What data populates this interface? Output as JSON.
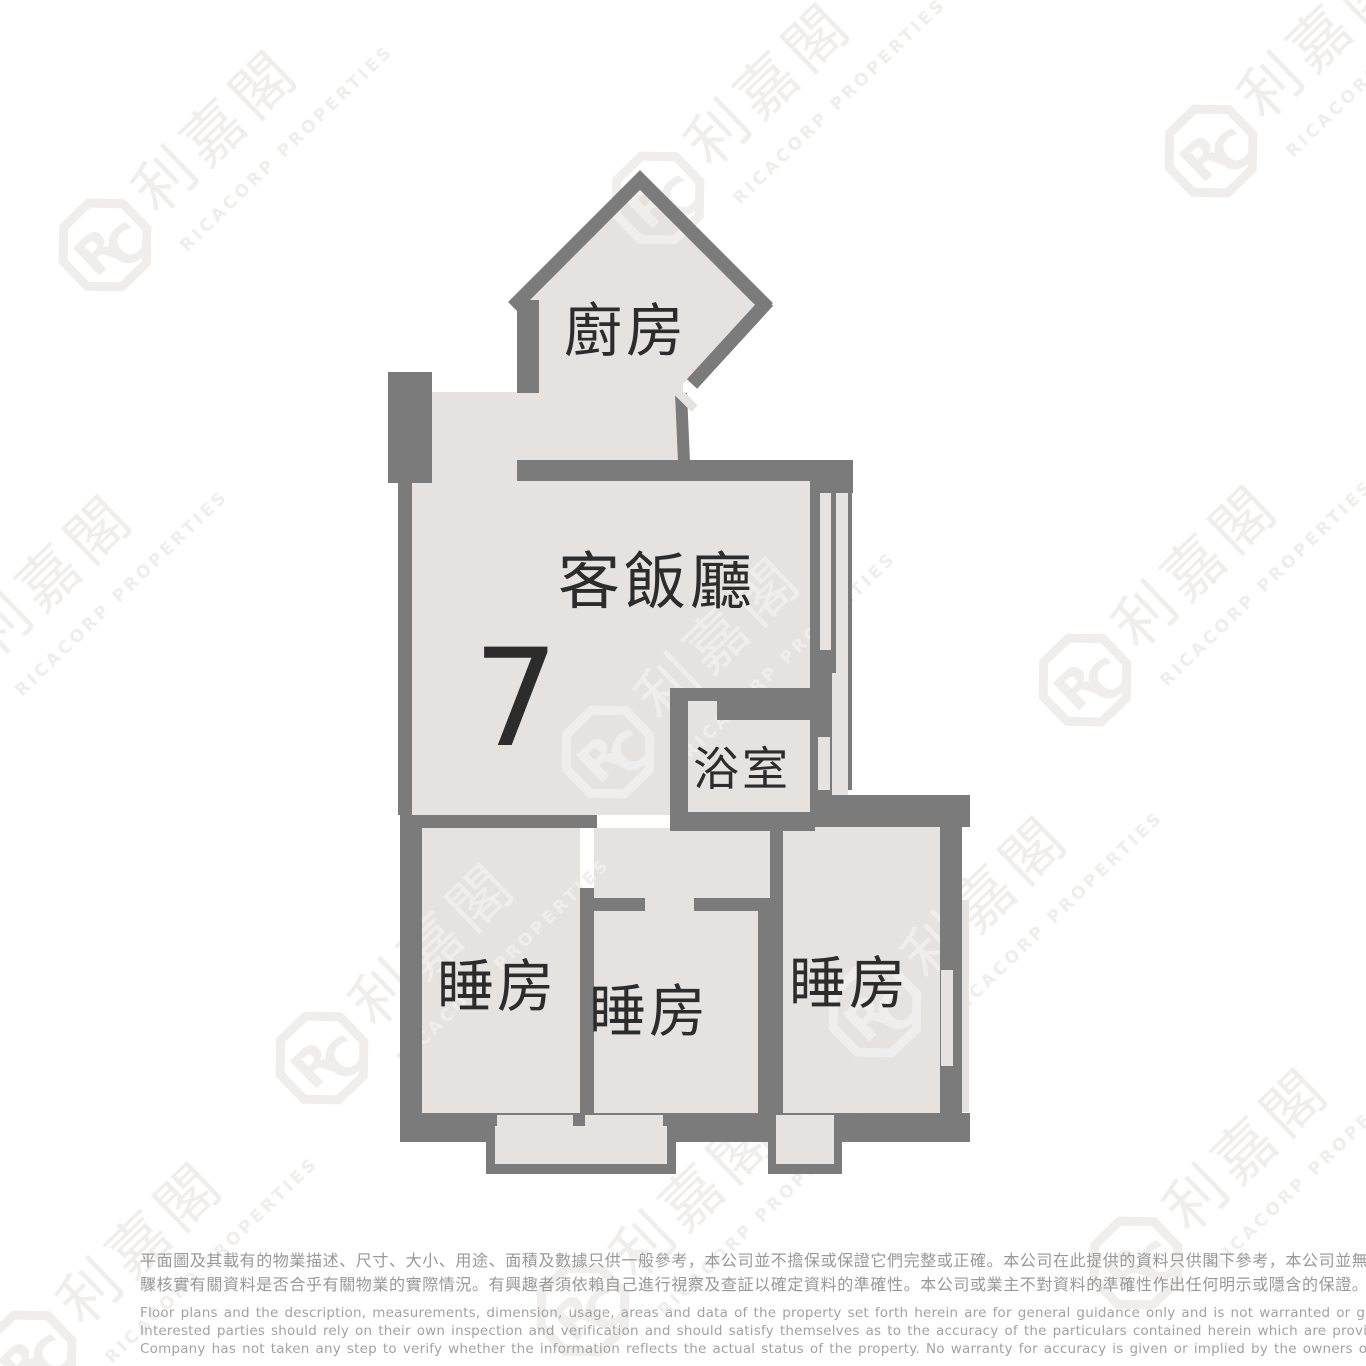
{
  "floor_plan": {
    "unit_number": "7",
    "rooms": [
      {
        "id": "kitchen",
        "label": "廚房"
      },
      {
        "id": "living_dining",
        "label": "客飯廳"
      },
      {
        "id": "bathroom",
        "label": "浴室"
      },
      {
        "id": "bedroom_left",
        "label": "睡房"
      },
      {
        "id": "bedroom_middle",
        "label": "睡房"
      },
      {
        "id": "bedroom_right",
        "label": "睡房"
      }
    ]
  },
  "watermark": {
    "logo_monogram_r": "R",
    "logo_monogram_c": "C",
    "brand_chinese": "利嘉閣",
    "brand_english": "RICACORP PROPERTIES"
  },
  "disclaimer": {
    "chinese_lines": [
      "平面圖及其載有的物業描述、尺寸、大小、用途、面積及數據只供一般參考，本公司並不擔保或保證它們完整或正確。本公司在此提供的資料只供閣下參考，本公司並無採取任何步",
      "驟核實有關資料是否合乎有關物業的實際情況。有興趣者須依賴自己進行視察及查証以確定資料的準確性。本公司或業主不對資料的準確性作出任何明示或隱含的保證。"
    ],
    "english_lines": [
      "Floor plans and the description, measurements, dimension, usage, areas and data of the property set forth herein are for general guidance only and is not warranted or guaranteed to be complete or correct.",
      "Interested parties should rely on their own inspection and verification and should satisfy themselves as to the accuracy of the particulars contained herein which are provided by us for information only.  Our",
      "Company has not taken any step to verify whether the information reflects the actual status of the property.  No warranty for accuracy is given or implied by the owners or us."
    ]
  },
  "colors": {
    "wall": "#7b7b7b",
    "floor": "#e6e2df",
    "label_text": "#2c2c2c",
    "watermark": "#f0eeec",
    "disclaimer_text": "#9a9a9a"
  }
}
